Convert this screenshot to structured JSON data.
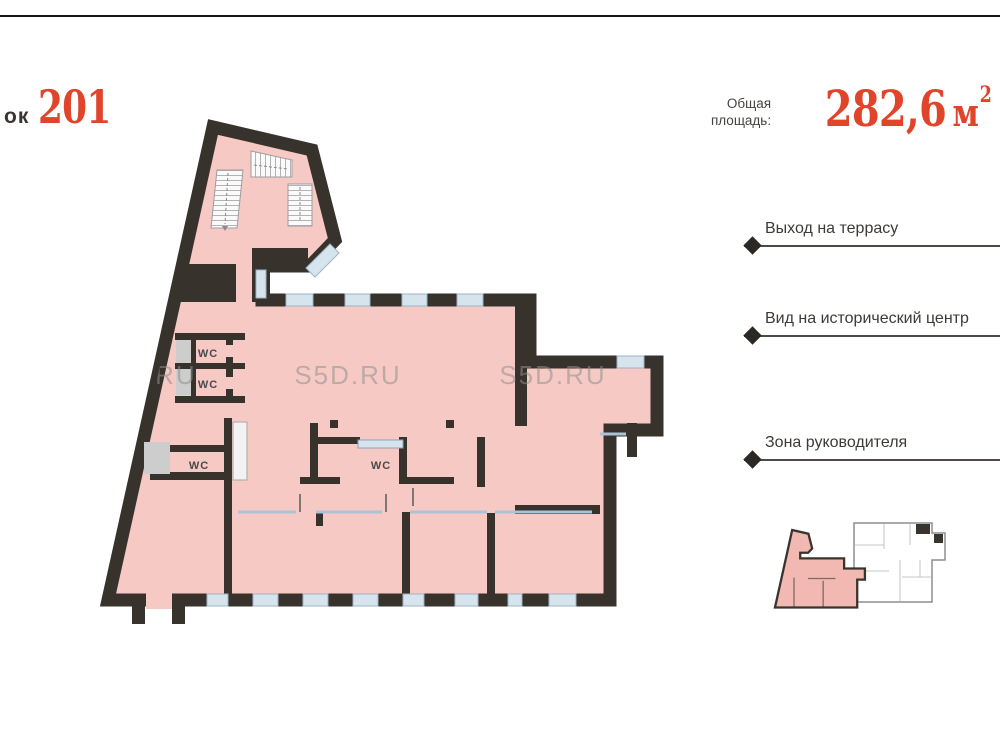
{
  "header": {
    "block_label_fragment": "ок",
    "block_number": "201",
    "area_label": "Общая площадь:",
    "area_value": "282,6",
    "area_unit": "м",
    "area_unit_exponent": "2"
  },
  "features": [
    {
      "label": "Выход на террасу"
    },
    {
      "label": "Вид на исторический центр"
    },
    {
      "label": "Зона руководителя"
    }
  ],
  "floor_plan": {
    "wc_labels": [
      "WC",
      "WC",
      "WC",
      "WC"
    ],
    "watermark": "S5D.RU",
    "colors": {
      "floor_pink": "#f6c9c4",
      "wall_dark": "#38322d",
      "window_blue": "#d6e4ee",
      "accent_red": "#e0452b",
      "shaft_gray": "#cdcdcd",
      "watermark_gray": "#8f8f8f"
    }
  }
}
